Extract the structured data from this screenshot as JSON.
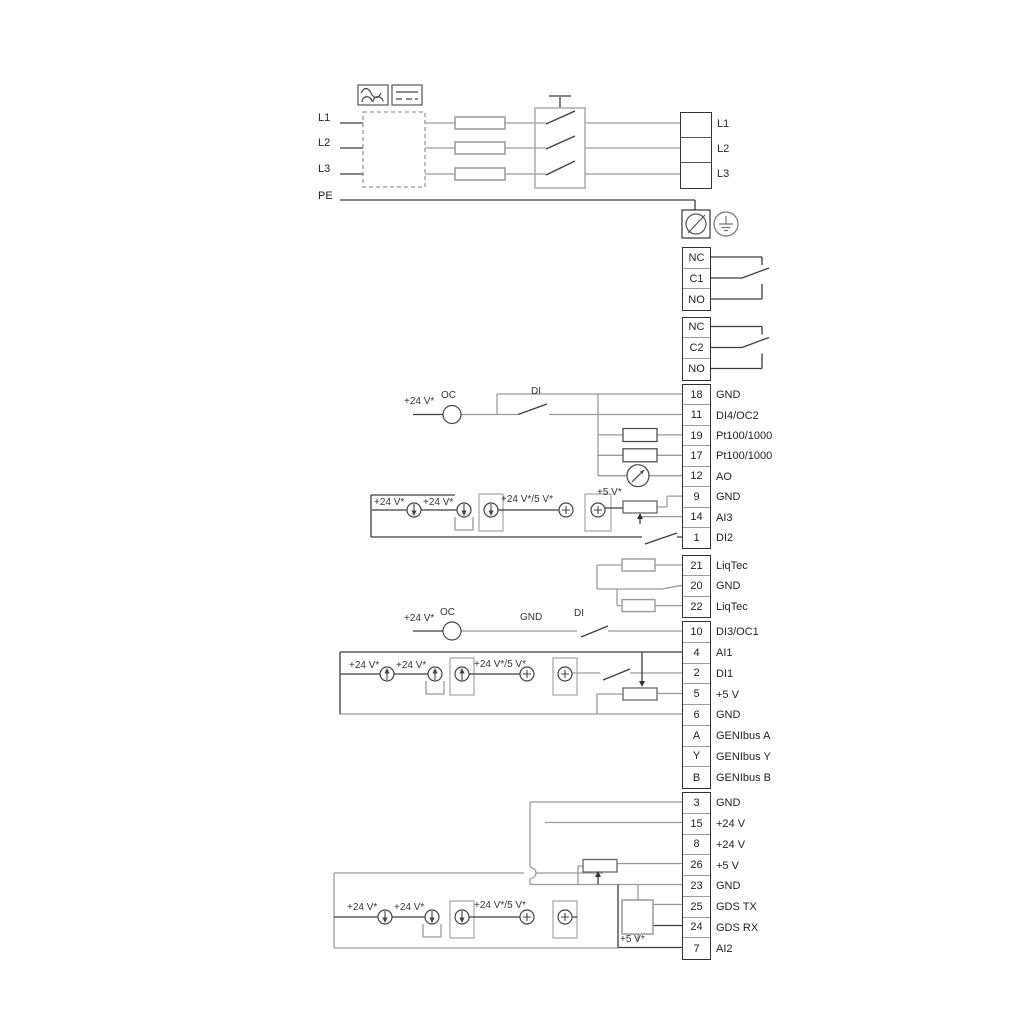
{
  "labels": {
    "v24": "+24 V*",
    "v24v5": "+24 V*/5 V*",
    "v5": "+5 V*",
    "oc": "OC",
    "di": "DI",
    "gnd": "GND"
  },
  "power": {
    "in": [
      {
        "t": "L1"
      },
      {
        "t": "L2"
      },
      {
        "t": "L3"
      },
      {
        "t": "PE"
      }
    ],
    "out": [
      {
        "t": "L1"
      },
      {
        "t": "L2"
      },
      {
        "t": "L3"
      }
    ]
  },
  "relay1": [
    {
      "t": "NC"
    },
    {
      "t": "C1"
    },
    {
      "t": "NO"
    }
  ],
  "relay2": [
    {
      "t": "NC"
    },
    {
      "t": "C2"
    },
    {
      "t": "NO"
    }
  ],
  "strip1": [
    {
      "num": "18",
      "label": "GND"
    },
    {
      "num": "11",
      "label": "DI4/OC2"
    },
    {
      "num": "19",
      "label": "Pt100/1000"
    },
    {
      "num": "17",
      "label": "Pt100/1000"
    },
    {
      "num": "12",
      "label": "AO"
    },
    {
      "num": "9",
      "label": "GND"
    },
    {
      "num": "14",
      "label": "AI3"
    },
    {
      "num": "1",
      "label": "DI2"
    }
  ],
  "liqtec": [
    {
      "num": "21",
      "label": "LiqTec"
    },
    {
      "num": "20",
      "label": "GND"
    },
    {
      "num": "22",
      "label": "LiqTec"
    }
  ],
  "strip3": [
    {
      "num": "10",
      "label": "DI3/OC1"
    },
    {
      "num": "4",
      "label": "AI1"
    },
    {
      "num": "2",
      "label": "DI1"
    },
    {
      "num": "5",
      "label": "+5 V"
    },
    {
      "num": "6",
      "label": "GND"
    },
    {
      "num": "A",
      "label": "GENIbus A"
    },
    {
      "num": "Y",
      "label": "GENIbus Y"
    },
    {
      "num": "B",
      "label": "GENIbus B"
    }
  ],
  "strip4": [
    {
      "num": "3",
      "label": "GND"
    },
    {
      "num": "15",
      "label": "+24 V"
    },
    {
      "num": "8",
      "label": "+24 V"
    },
    {
      "num": "26",
      "label": "+5 V"
    },
    {
      "num": "23",
      "label": "GND"
    },
    {
      "num": "25",
      "label": "GDS TX"
    },
    {
      "num": "24",
      "label": "GDS RX"
    },
    {
      "num": "7",
      "label": "AI2"
    }
  ],
  "colors": {
    "wire_gray": "#9a9a9a",
    "wire_dark": "#3d3d3d"
  }
}
